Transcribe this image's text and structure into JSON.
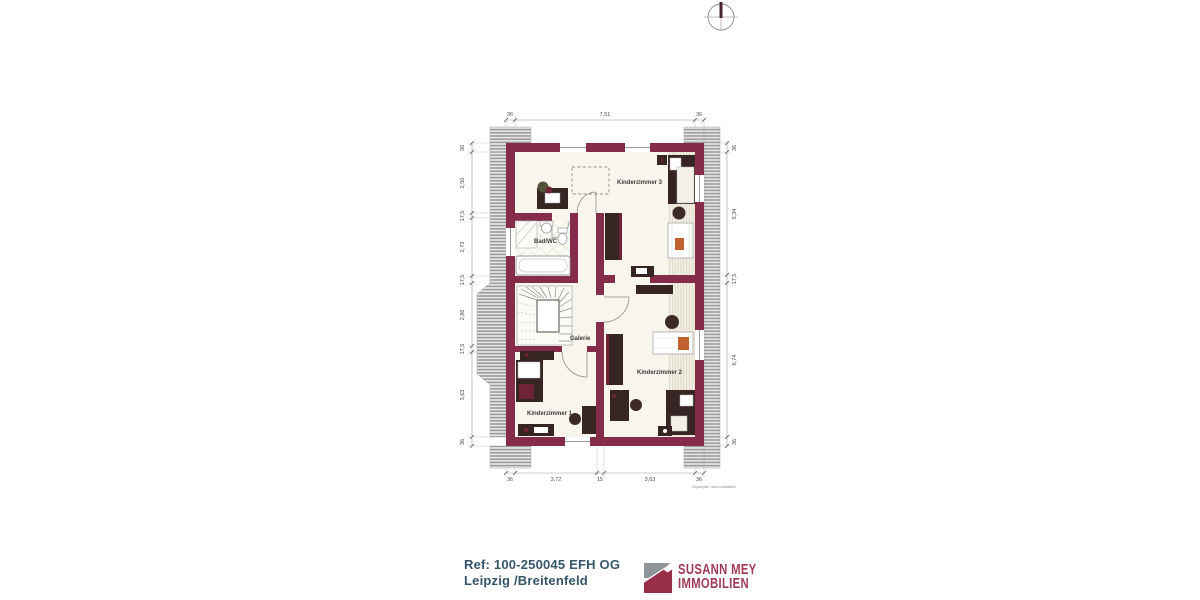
{
  "plan": {
    "title_hint": "floor plan upper storey",
    "rooms": [
      {
        "label": "Kinderzimmer 3"
      },
      {
        "label": "Bad/WC"
      },
      {
        "label": "Galerie"
      },
      {
        "label": "Kinderzimmer 2"
      },
      {
        "label": "Kinderzimmer 1"
      }
    ],
    "dimensions": {
      "top": [
        "36",
        "7,51",
        "36"
      ],
      "bottom": [
        "36",
        "3,72",
        "15",
        "3,63",
        "36"
      ],
      "left": [
        "36",
        "2,50",
        "17,5",
        "2,73",
        "17,5",
        "2,86",
        "17,5",
        "3,63",
        "36"
      ],
      "right": [
        "36",
        "5,34",
        "17,5",
        "6,74",
        "36"
      ]
    },
    "note": "Exposéplan, nicht maßstäblich"
  },
  "footer": {
    "ref": "Ref: 100-250045 EFH OG",
    "location": "Leipzig /Breitenfeld"
  },
  "logo": {
    "line1": "SUSANN MEY",
    "line2": "IMMOBILIEN"
  },
  "colors": {
    "wall": "#862c4b",
    "brand": "#a13a54",
    "footer_text": "#35566a"
  }
}
